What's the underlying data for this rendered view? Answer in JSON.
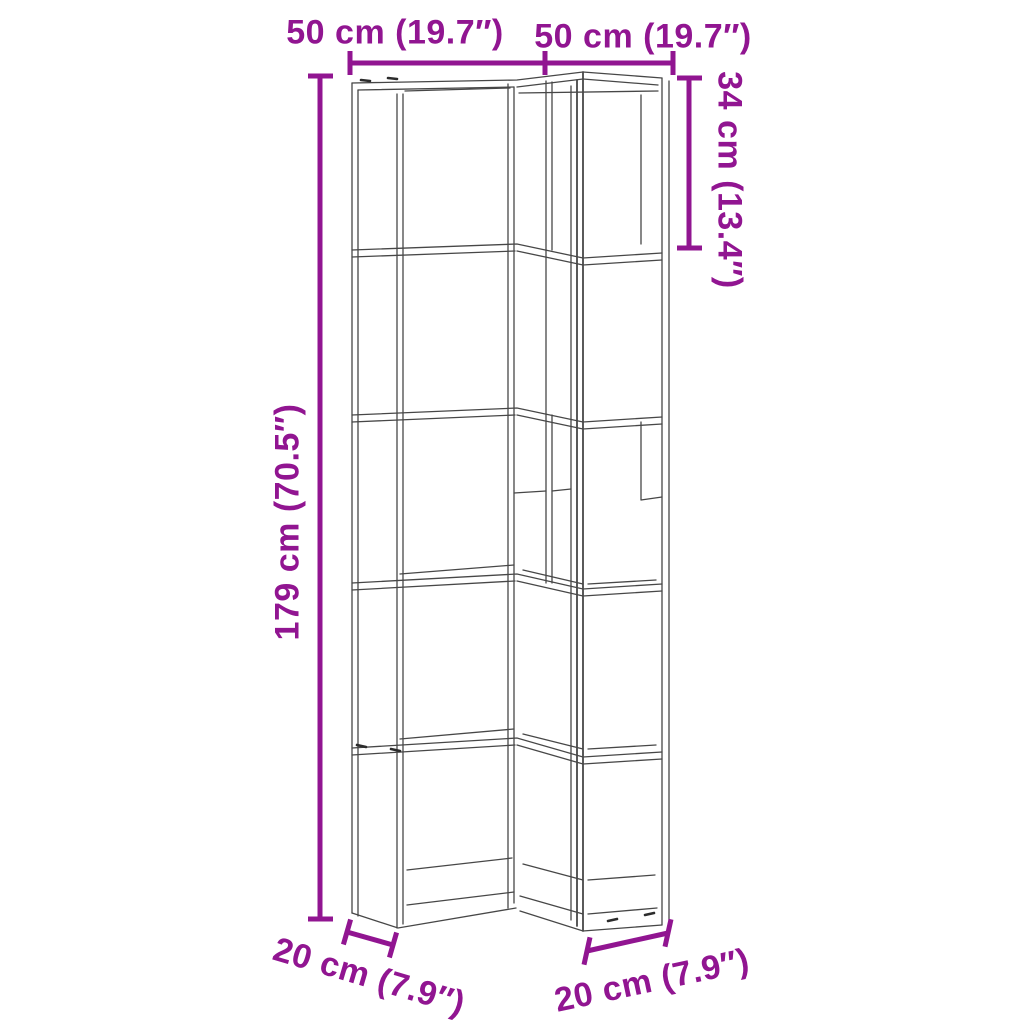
{
  "diagram": {
    "type": "furniture-dimension-diagram",
    "subject": "5-tier corner bookshelf wireframe",
    "colors": {
      "background": "#ffffff",
      "dimension_accent": "#911591",
      "wireframe_line": "#474747"
    },
    "dimensions": {
      "top_left_width": "50 cm (19.7″)",
      "top_right_width": "50 cm (19.7″)",
      "right_section_height": "34 cm (13.4″)",
      "total_height": "179 cm (70.5″)",
      "bottom_left_depth": "20 cm (7.9″)",
      "bottom_right_depth": "20 cm (7.9″)"
    }
  }
}
